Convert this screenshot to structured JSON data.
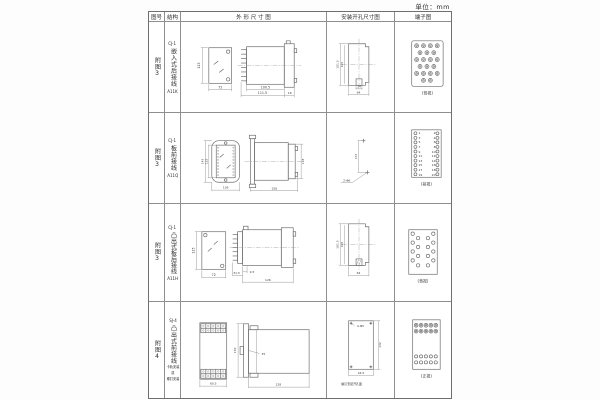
{
  "page": {
    "unit": "单位：mm"
  },
  "table": {
    "headers": {
      "figure": "图号",
      "structure": "结构",
      "outline": "外 形 尺 寸 图",
      "install": "安装开孔尺寸图",
      "terminal": "端子图"
    },
    "rows": [
      {
        "figure_no": "附图3",
        "structure": {
          "model": "CJ-1",
          "desc": "嵌入式后接线",
          "code": "A11K"
        },
        "outline": {
          "front_h": "115",
          "front_w": "72",
          "d1": "100.5",
          "d2": "111.5",
          "d3": "16"
        },
        "install": {
          "v1": "101.5",
          "v2": "105",
          "h1": "14",
          "h2": "64"
        },
        "terminal": {
          "label": "(背视)"
        }
      },
      {
        "figure_no": "附图3",
        "structure": {
          "model": "CJ-1",
          "desc": "板前接线",
          "code": "A11Q"
        },
        "outline": {
          "h_outer": "145",
          "h_inner": "125",
          "w": "105",
          "len": "156",
          "side_h": "118"
        },
        "install": {
          "v": "133",
          "hole": "2-Φ6"
        },
        "terminal": {
          "label": "(前视)",
          "left_nums": "1\n3\n5\n7\n9\n11\n13\n15\n17\n19",
          "right_nums": "2\n4\n6\n8\n10\n12\n14\n16\n18\n20"
        }
      },
      {
        "figure_no": "附图3",
        "structure": {
          "model": "CJ-1",
          "desc": "凸出式板后接线",
          "code": "A11H"
        },
        "outline": {
          "front_h": "115",
          "front_w": "72",
          "d1": "31.5",
          "d2": "9.5",
          "d3": "126"
        },
        "install": {
          "v1": "101.5",
          "v2": "105",
          "h": "64"
        },
        "terminal": {
          "label": "(背视)"
        }
      },
      {
        "figure_no": "附图4",
        "structure": {
          "model": "SJ-4",
          "desc": "凸出式前接线",
          "note1": "卡轨安装",
          "note2": "或",
          "note3": "螺钉安装"
        },
        "outline": {
          "front_w": "60.5",
          "side_h": "130",
          "side_d": "35",
          "side_len": "128"
        },
        "install": {
          "holes": "4-Φ5",
          "v": "132",
          "h": "44.5",
          "caption": "螺钉安装开孔图"
        },
        "terminal": {
          "label": "(正视)"
        }
      }
    ]
  }
}
